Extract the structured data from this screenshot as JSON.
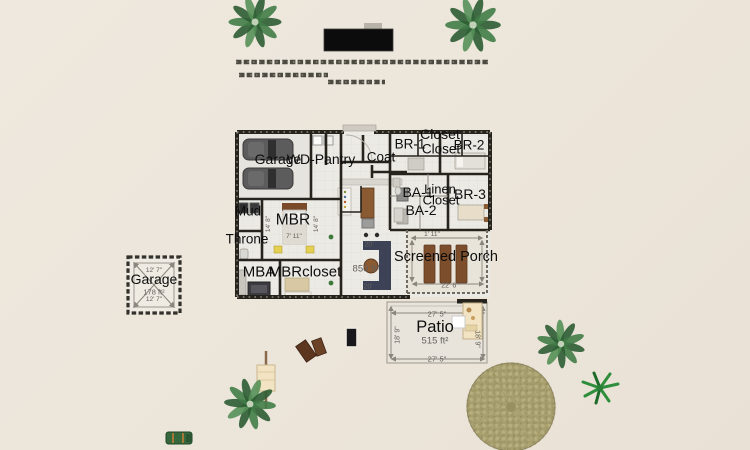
{
  "labels": {
    "garage": "Garage",
    "wd_pantry": "WD-Pantry",
    "coat": "Coat",
    "closet": "Closet",
    "br1": "BR-1",
    "br2": "BR-2",
    "br3": "BR-3",
    "ba1": "BA-1",
    "ba2": "BA-2",
    "linen": "Linen",
    "mud": "Mud",
    "throne": "Throne",
    "mbr": "MBR",
    "mba": "MBA",
    "mbr_closet": "MBRcloset",
    "screened_porch": "Screened Porch",
    "patio": "Patio"
  },
  "dims": {
    "w12_7": "12' 7\"",
    "w14_8": "14' 8\"",
    "w7_11": "7' 11\"",
    "w1_11": "1' 11\"",
    "w22_6": "22' 6\"",
    "w27_5": "27' 5\"",
    "w18_9": "18' 9\"",
    "w20": "20'"
  },
  "areas": {
    "patio": "515 ft²",
    "detached_garage": "178 ft²",
    "great_room": "850 ft²"
  },
  "colors": {
    "background": "#ece5da",
    "wall": "#26231d",
    "floor": "#eceae5",
    "porch_floor": "#e9e4da",
    "patio_floor": "#e8e4dc",
    "pool_table": "#0c0c0c",
    "car": "#5c5c5c",
    "sofa": "#3d4257",
    "wood": "#8a5a33",
    "plank": "#7c4e2b",
    "palm": "#3c7446",
    "pebble": "#a79e6e",
    "vehicle": "#35673d",
    "bench": "#f2e4c3",
    "mat": "#5d3620"
  }
}
